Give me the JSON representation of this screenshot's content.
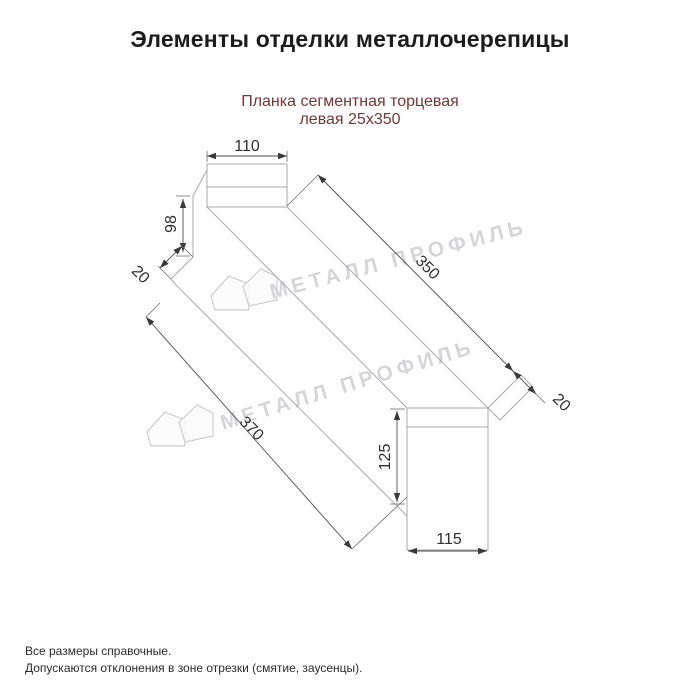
{
  "page": {
    "title": "Элементы отделки металлочерепицы",
    "subtitle_line1": "Планка сегментная торцевая",
    "subtitle_line2": "левая 25х350",
    "notes": [
      "Все размеры справочные.",
      "Допускаются отклонения в зоне отрезки (смятие, заусенцы)."
    ]
  },
  "drawing": {
    "type": "technical-dimension-diagram",
    "product": "Планка сегментная торцевая левая 25х350",
    "dimensions": {
      "top_width": "110",
      "left_height": "98",
      "left_flange": "20",
      "top_edge_length": "350",
      "bottom_edge_length": "370",
      "right_height": "125",
      "right_width": "115",
      "right_flange": "20"
    }
  },
  "watermark": {
    "text": "МЕТАЛЛ ПРОФИЛЬ",
    "logo": "metall-profil-logo"
  },
  "colors": {
    "background": "#ffffff",
    "title": "#1c1c1c",
    "subtitle": "#7a3333",
    "object_line": "#a9a9af",
    "dimension_line": "#4a4a4a",
    "dimension_text": "#2e2e2e",
    "watermark": "#c9c9cd"
  }
}
